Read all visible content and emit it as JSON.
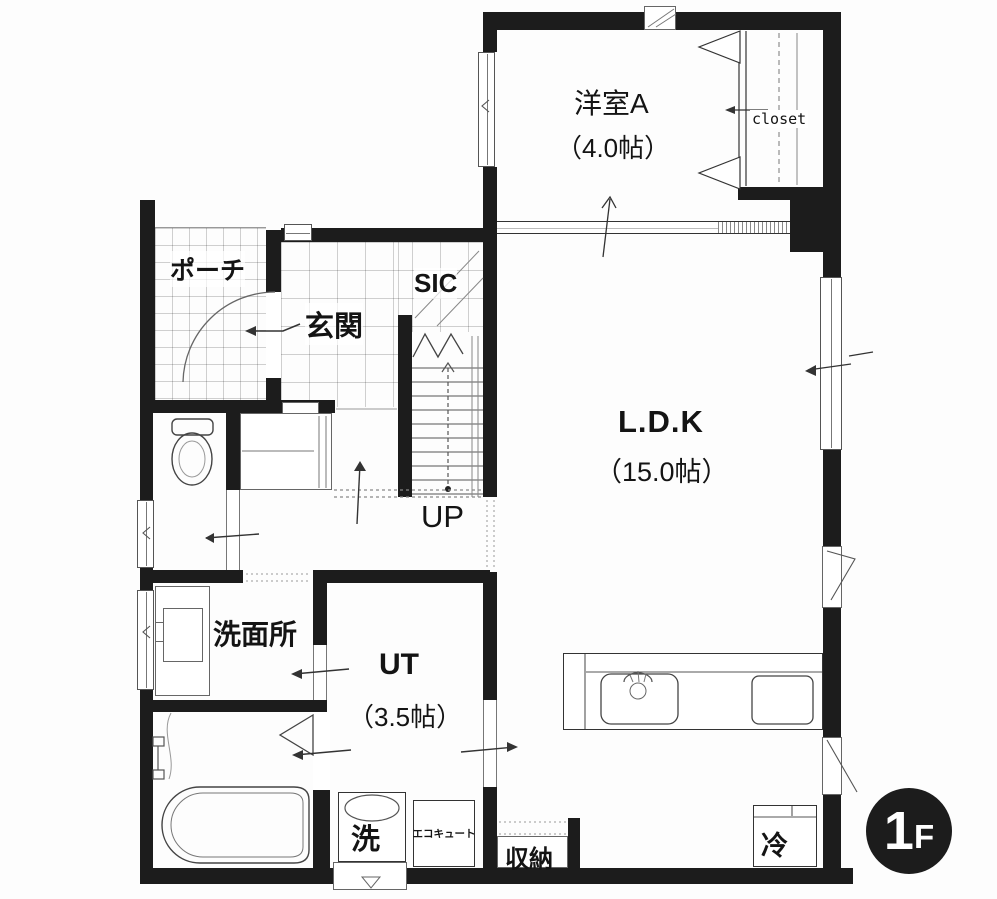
{
  "floor_badge": {
    "number": "1",
    "suffix": "F"
  },
  "rooms": {
    "western_a": {
      "name": "洋室A",
      "size": "（4.0帖）"
    },
    "closet": {
      "name": "closet"
    },
    "ldk": {
      "name": "L.D.K",
      "size": "（15.0帖）"
    },
    "entrance": {
      "name": "玄関"
    },
    "porch": {
      "name": "ポーチ"
    },
    "sic": {
      "name": "SIC"
    },
    "stairs": {
      "label": "UP"
    },
    "washroom": {
      "name": "洗面所"
    },
    "utility": {
      "name": "UT",
      "size": "（3.5帖）"
    },
    "storage": {
      "name": "収納"
    }
  },
  "fixtures": {
    "washer": {
      "label": "洗"
    },
    "ecocute": {
      "label": "エコキュート"
    },
    "fridge": {
      "label": "冷"
    }
  }
}
